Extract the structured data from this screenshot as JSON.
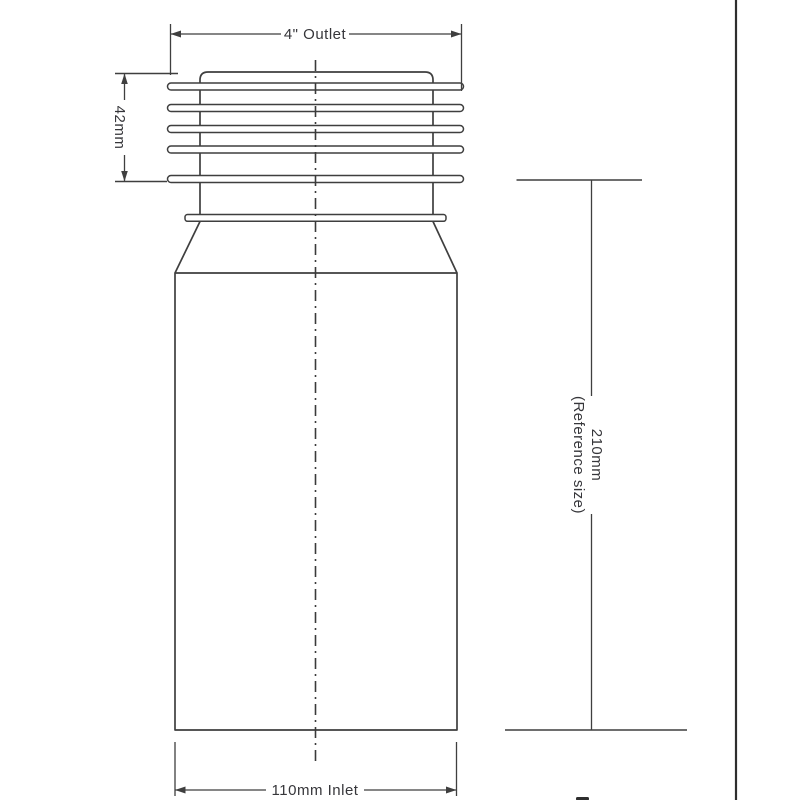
{
  "colors": {
    "background": "#ffffff",
    "line": "#3f3f3f",
    "text": "#36363a"
  },
  "labels": {
    "outlet": "4\" Outlet",
    "seal_height": "42mm",
    "reference_height": "210mm",
    "reference_note": "(Reference size)",
    "inlet": "110mm Inlet"
  }
}
